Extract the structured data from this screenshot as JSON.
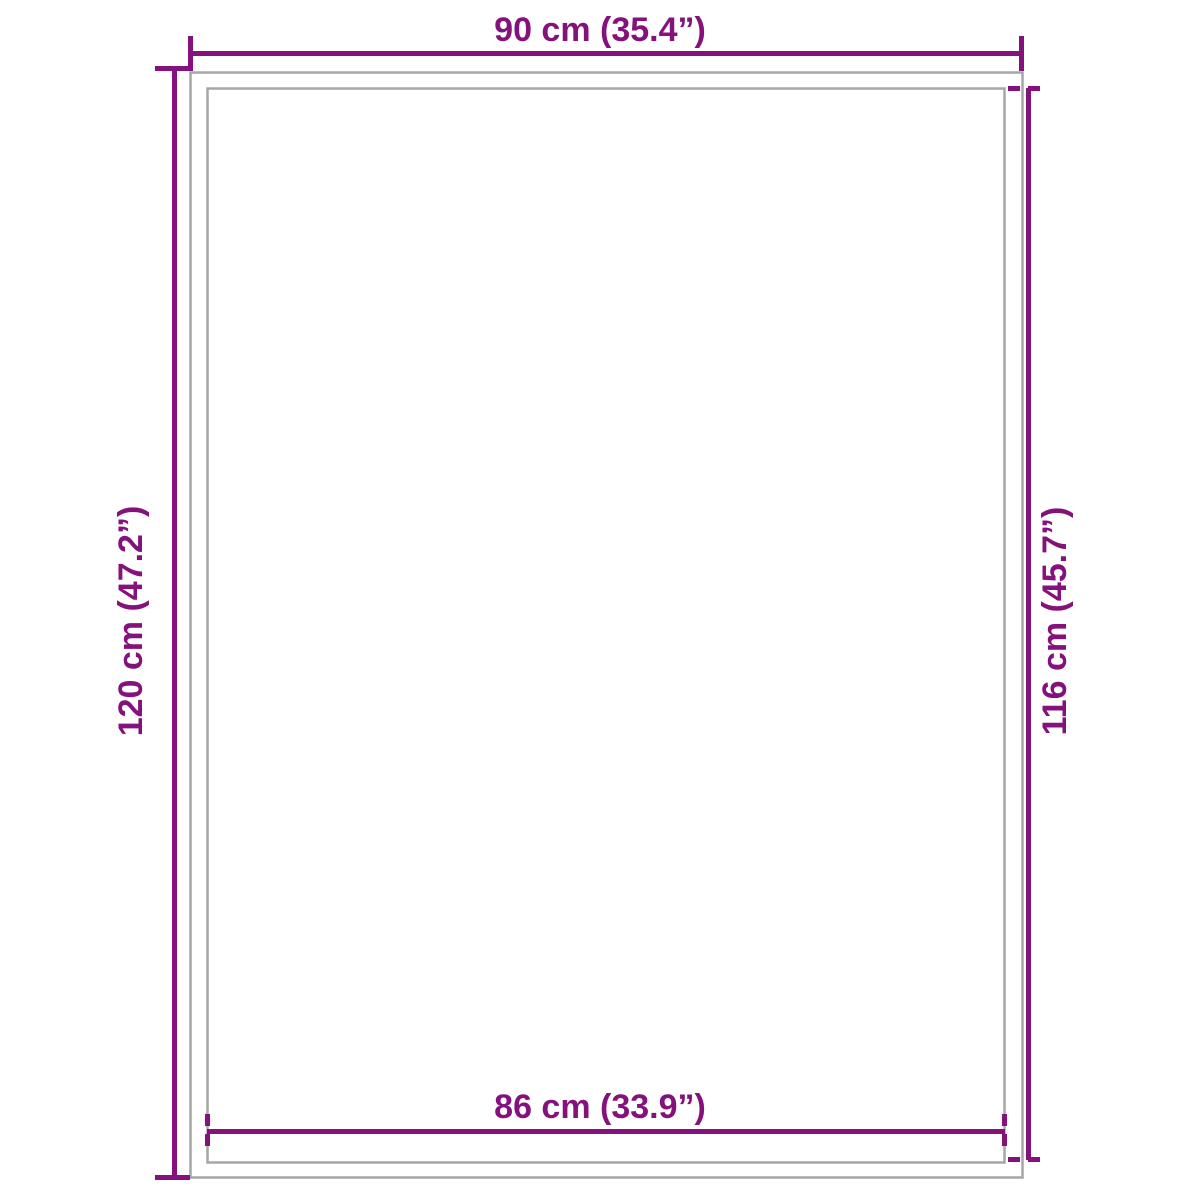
{
  "diagram": {
    "kind": "product-dimension-diagram",
    "colors": {
      "accent": "#84117C",
      "outline": "#A6A6A6",
      "background": "#FFFFFF"
    },
    "dimensions": {
      "top": {
        "label": "90 cm (35.4”)",
        "value_cm": 90,
        "value_in": 35.4
      },
      "left": {
        "label": "120 cm (47.2”)",
        "value_cm": 120,
        "value_in": 47.2
      },
      "right": {
        "label": "116 cm (45.7”)",
        "value_cm": 116,
        "value_in": 45.7
      },
      "bottom": {
        "label": "86 cm (33.9”)",
        "value_cm": 86,
        "value_in": 33.9
      }
    }
  }
}
